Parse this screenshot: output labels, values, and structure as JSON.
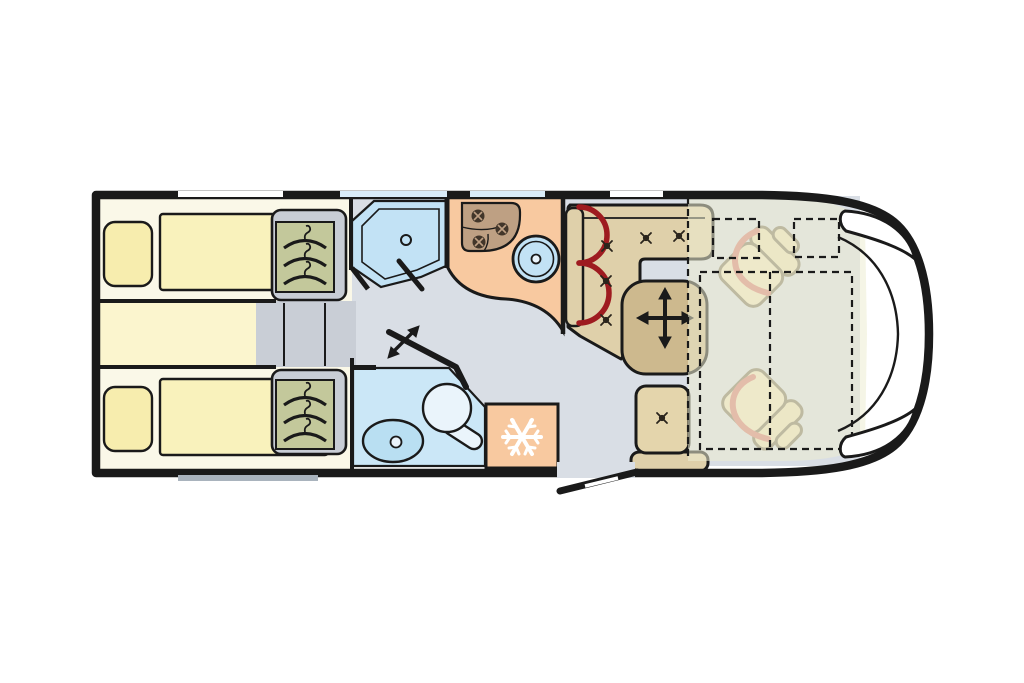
{
  "palette": {
    "page_bg": "#FFFFFF",
    "outline": "#1A1A1A",
    "floor": "#D9DEE5",
    "bedroom_floor": "#FAF8E8",
    "bed_platform": "#FBF5CE",
    "mattress": "#F9F2BC",
    "pillow": "#F7EDAE",
    "wardrobe_panel": "#C8CDD5",
    "wardrobe_interior": "#C3C89B",
    "steps": "#C9CED6",
    "shower": "#C2E2F5",
    "washroom": "#CBE7F7",
    "basin": "#B9DFF2",
    "toilet": "#EAF4FB",
    "kitchen": "#F8C9A0",
    "stove": "#BEA083",
    "burner": "#42362A",
    "sink": "#C2E2F5",
    "fridge": "#F8C9A0",
    "snowflake": "#FFFFFF",
    "bench": "#DFD0AA",
    "table": "#CDB98E",
    "side_seat": "#E4D5AC",
    "cab_seat": "#F0E5C2",
    "cab_seat_back": "#EBDFB8",
    "cab_seat_outline": "#857D66",
    "belt_arc": "#9E1B20",
    "swivel_arc": "#D8837A",
    "overlay_bed": "#ECECD2",
    "window_white": "#FFFFFF",
    "window_glass": "#D9EBF8",
    "window_rear": "#A9B3BD"
  },
  "features": [
    "single-bed-top",
    "single-bed-bottom",
    "pillow",
    "wardrobe",
    "clothes-hanger-icon",
    "bed-steps",
    "shower-room",
    "shower-door",
    "shower-drain",
    "kitchen-block",
    "three-burner-hob",
    "burner-icon",
    "kitchen-sink",
    "washroom",
    "toilet",
    "washbasin",
    "pivoting-door",
    "pivot-arrow-icon",
    "fridge",
    "snowflake-icon",
    "l-shaped-dinette",
    "seat-belt-arc",
    "movable-table",
    "table-move-arrows-icon",
    "seat-button-icon",
    "side-seat",
    "entrance-door",
    "swivel-cab-seat",
    "seat-swivel-arc",
    "drop-down-bed-outline",
    "vehicle-body",
    "rear-window",
    "side-window",
    "windshield",
    "side-mirror"
  ]
}
